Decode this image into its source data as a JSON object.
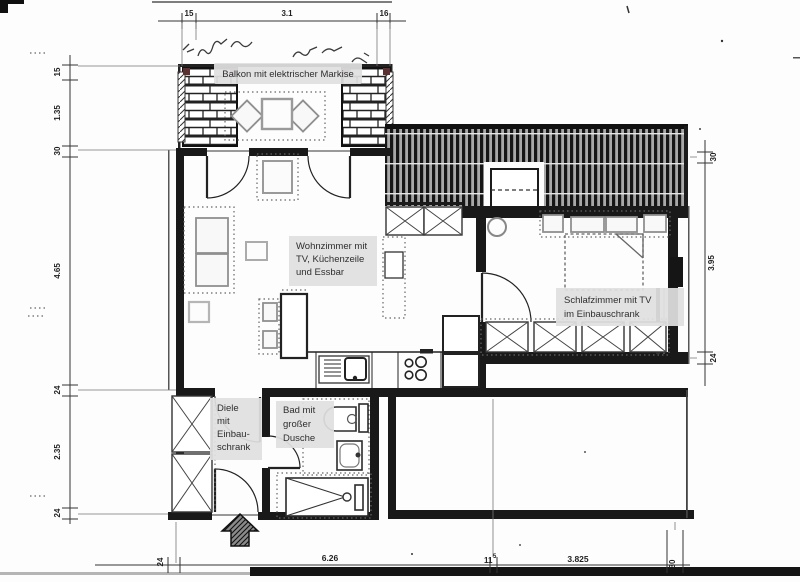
{
  "labels": {
    "balkon": "Balkon mit elektrischer Markise",
    "wohnzimmer": [
      "Wohnzimmer mit",
      "TV, Küchenzeile",
      "und Essbar"
    ],
    "schlafzimmer": [
      "Schlafzimmer mit TV",
      "im Einbauschrank"
    ],
    "diele": [
      "Diele",
      "mit",
      "Einbau-",
      "schrank"
    ],
    "bad": [
      "Bad mit",
      "großer",
      "Dusche"
    ]
  },
  "dimensions": {
    "top": {
      "left_wall": "15",
      "span": "3.1",
      "right_wall": "16"
    },
    "left": {
      "parapet": "15",
      "balkon_depth": "1.35",
      "wall_top": "30",
      "wohnzimmer_height": "4.65",
      "wall_mid": "24",
      "diele_height": "2.35",
      "wall_bottom": "24"
    },
    "right": {
      "wall_top": "30",
      "schlafzimmer_height": "3.95",
      "wall_bottom": "24"
    },
    "bottom": {
      "wall_left": "24",
      "wohnzimmer_width": "6.26",
      "wall_mid_main": "11",
      "wall_mid_sup": "5",
      "schlafzimmer_width": "3.825",
      "wall_right": "30"
    }
  }
}
